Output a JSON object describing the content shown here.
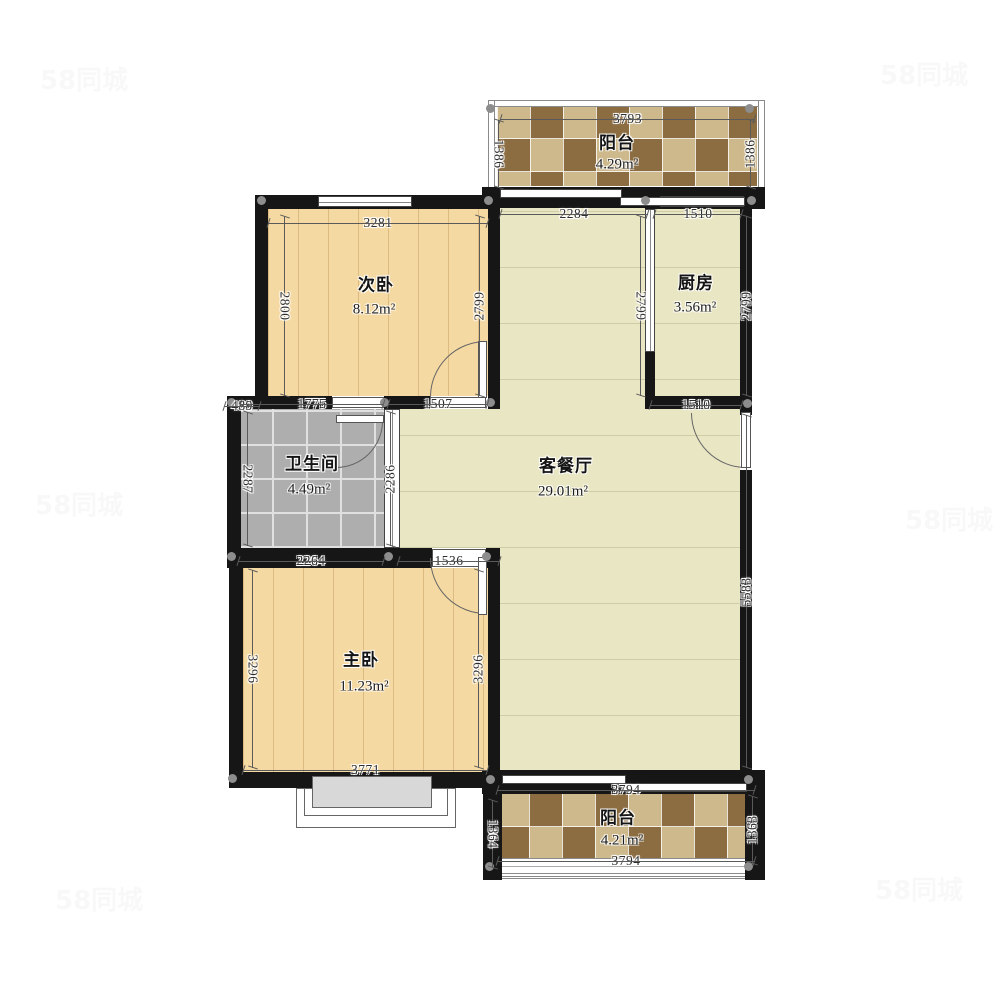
{
  "floorplan": {
    "rooms": {
      "balcony_top": {
        "name": "阳台",
        "area": "4.29m²"
      },
      "bedroom2": {
        "name": "次卧",
        "area": "8.12m²"
      },
      "kitchen": {
        "name": "厨房",
        "area": "3.56m²"
      },
      "living_dining": {
        "name": "客餐厅",
        "area": "29.01m²"
      },
      "bathroom": {
        "name": "卫生间",
        "area": "4.49m²"
      },
      "master": {
        "name": "主卧",
        "area": "11.23m²"
      },
      "balcony_bottom": {
        "name": "阳台",
        "area": "4.21m²"
      }
    },
    "dims": {
      "balcony_top_width": "3793",
      "balcony_top_left": "1386",
      "balcony_top_right": "1386",
      "living_top": "2284",
      "kitchen_top": "1510",
      "bedroom2_top": "3281",
      "bedroom2_left": "2800",
      "bedroom2_right": "2799",
      "kitchen_left": "2799",
      "kitchen_right": "2799",
      "kitchen_bottom": "1510",
      "bathroom_offset": "489",
      "bathroom_top": "1775",
      "passage": "1507",
      "bathroom_left": "2287",
      "bathroom_right": "2286",
      "living_right": "5583",
      "master_top": "2264",
      "master_door": "1536",
      "master_left": "3296",
      "master_right": "3296",
      "master_bottom": "3771",
      "balcony_bottom_top": "3794",
      "balcony_bottom_left": "1364",
      "balcony_bottom_right": "1363",
      "balcony_bottom_bottom": "3794"
    },
    "watermark": "58同城",
    "colors": {
      "wall": "#161616",
      "wood_floor": "#f5d9a2",
      "wood_line": "#ddbb80",
      "living_floor": "#e9e6c4",
      "bathroom_tile": "#aeaeae",
      "kitchen_floor": "#f4f4f1",
      "balcony_tile_dark": "#8c6d41",
      "balcony_tile_light": "#cdb98c"
    }
  }
}
